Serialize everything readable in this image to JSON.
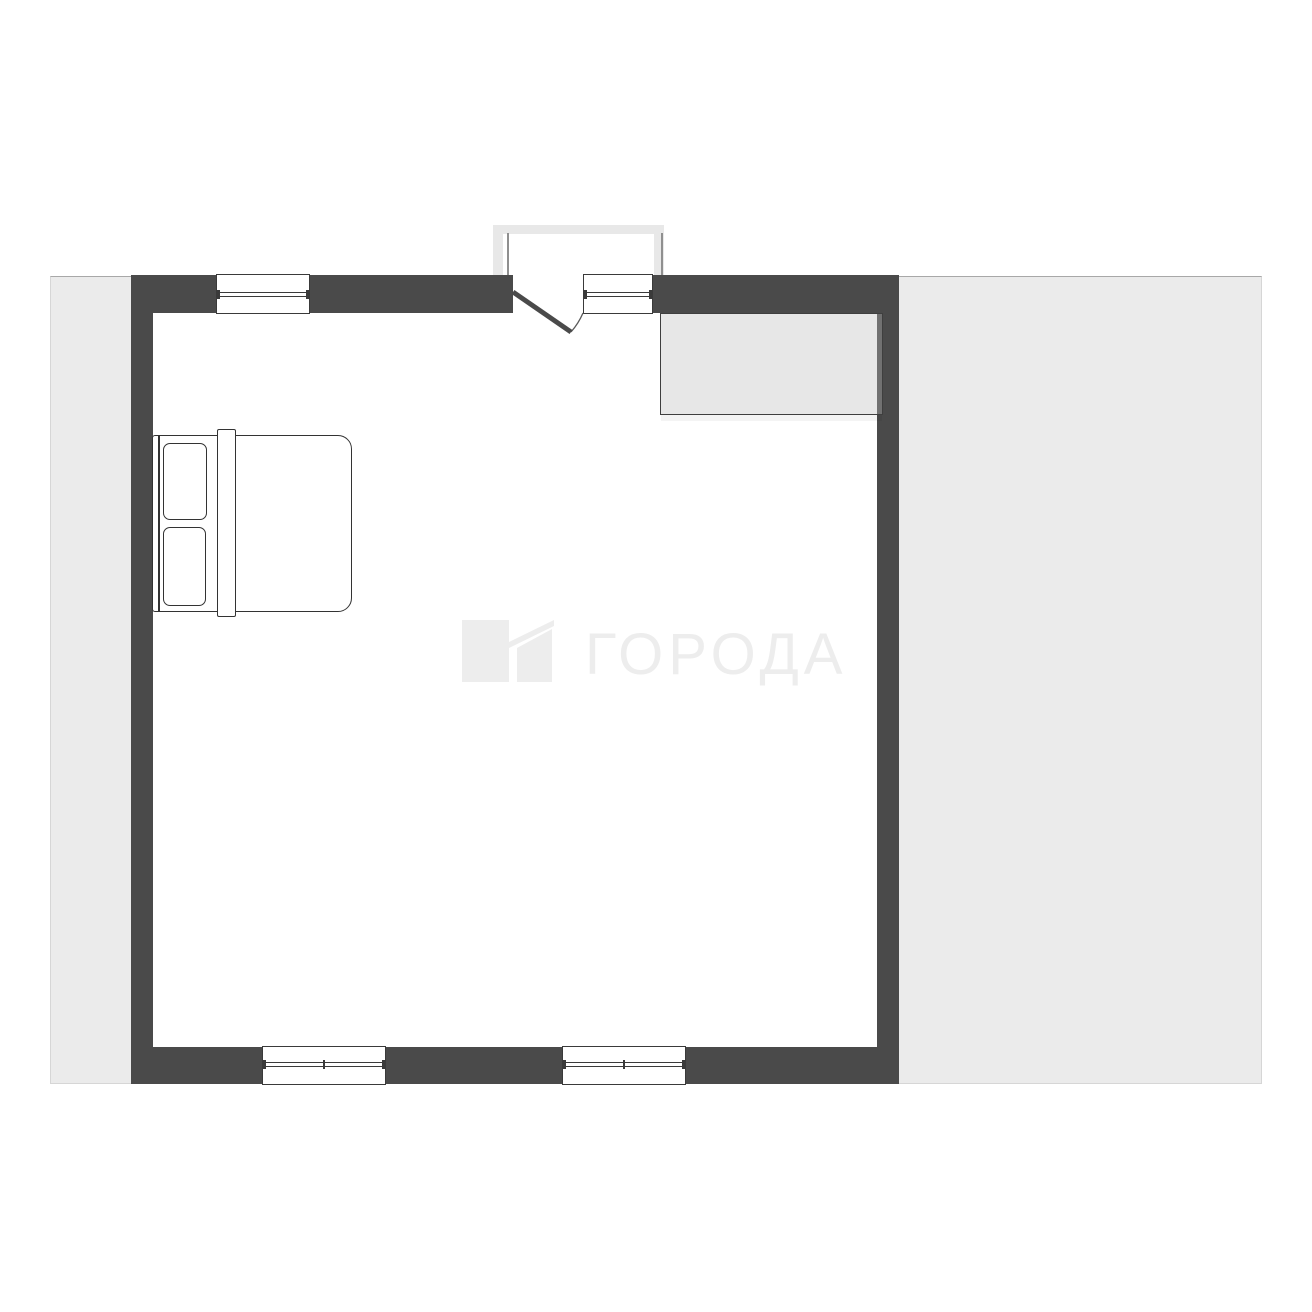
{
  "title": "apartment-floor-plan",
  "watermark": {
    "text": "ГОРОДА"
  },
  "colors": {
    "background": "#ffffff",
    "outdoor_band": "#ebebeb",
    "wall": "#4a4a4a",
    "furniture_stroke": "#333333",
    "vestibule": "#e8e8e8",
    "watermark": "#ededed",
    "wardrobe_fill": "rgba(186,186,186,0.35)"
  },
  "plan": {
    "rooms": 1,
    "furniture": [
      "double-bed",
      "wardrobe"
    ],
    "openings": {
      "windows": 4,
      "entrance_doors": 1
    }
  }
}
